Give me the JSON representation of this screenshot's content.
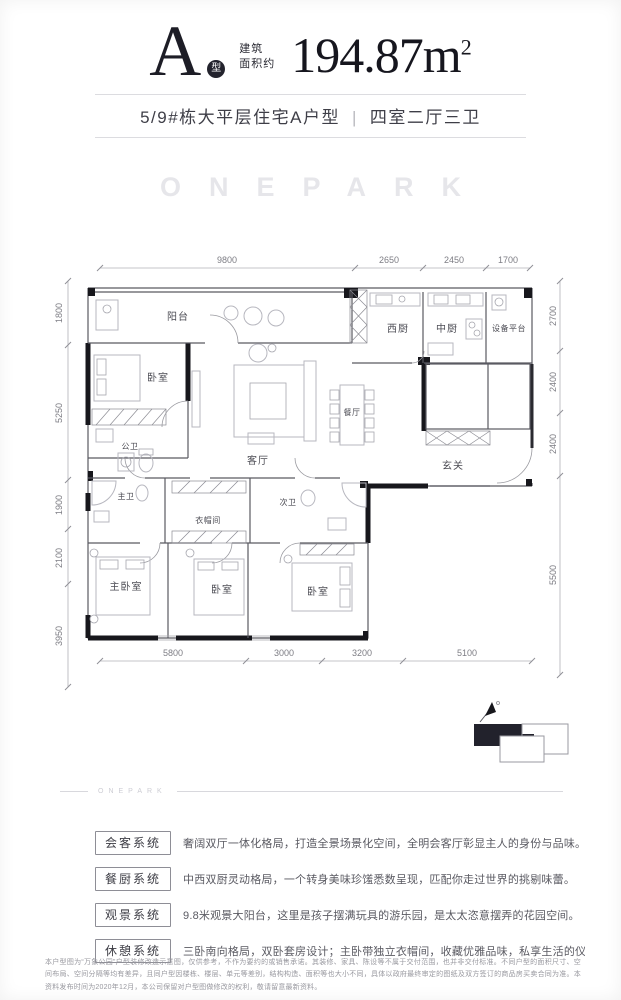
{
  "colors": {
    "ink": "#17171c",
    "badge": "#23232d",
    "watermark": "#e6e6ea"
  },
  "header": {
    "type_letter": "A",
    "type_badge": "型",
    "area_prefix_line1": "建筑",
    "area_prefix_line2": "面积约",
    "area_value": "194.87",
    "area_unit": "m",
    "area_unit_sup": "2",
    "subtitle_left": "5/9#栋大平层住宅A户型",
    "subtitle_sep": "|",
    "subtitle_right": "四室二厅三卫"
  },
  "watermark": "ONEPARK",
  "floorplan": {
    "rooms": {
      "balcony": "阳台",
      "west_kitchen": "西厨",
      "chinese_kitchen": "中厨",
      "equipment_platform": "设备平台",
      "bedroom_top": "卧室",
      "public_bath": "公卫",
      "living_room": "客厅",
      "dining_room": "餐厅",
      "foyer": "玄关",
      "master_bath": "主卫",
      "cloakroom": "衣帽间",
      "second_bath": "次卫",
      "master_bedroom": "主卧室",
      "bedroom_mid": "卧室",
      "bedroom_right": "卧室"
    },
    "dims": {
      "top": [
        "9800",
        "2650",
        "2450",
        "1700"
      ],
      "left": [
        "1800",
        "5250",
        "1900",
        "2100",
        "3950"
      ],
      "right": [
        "2700",
        "2400",
        "2400",
        "5500"
      ],
      "bottom": [
        "5800",
        "3000",
        "3200",
        "5100"
      ]
    }
  },
  "divider_watermark": "ONEPARK",
  "features": [
    {
      "label": "会客系统",
      "text": "奢阔双厅一体化格局，打造全景场景化空间，全明会客厅彰显主人的身份与品味。"
    },
    {
      "label": "餐厨系统",
      "text": "中西双厨灵动格局，一个转身美味珍馐悉数呈现，匹配你走过世界的挑剔味蕾。"
    },
    {
      "label": "观景系统",
      "text": "9.8米观景大阳台，这里是孩子摆满玩具的游乐园，是太太恣意摆弄的花园空间。"
    },
    {
      "label": "休憩系统",
      "text": "三卧南向格局，双卧套房设计；主卧带独立衣帽间，收藏优雅品味，私享生活的仪式感。"
    }
  ],
  "disclaimer": "本户型图为“万象公园”户型装修改造示意图，仅供参考，不作为要约的或销售承诺。其装修、家具、陈设等不属于交付范围，也并非交付标准。不同户型的面积尺寸、空间布局、空间分隔等均有差异，且同户型因楼栋、楼层、单元等差别，结构构造、面积等也大小不同，具体以政府最终审定的图纸及双方签订的商品房买卖合同为准。本资料发布时间为2020年12月，本公司保留对户型图做修改的权利，敬请留意最新资料。"
}
